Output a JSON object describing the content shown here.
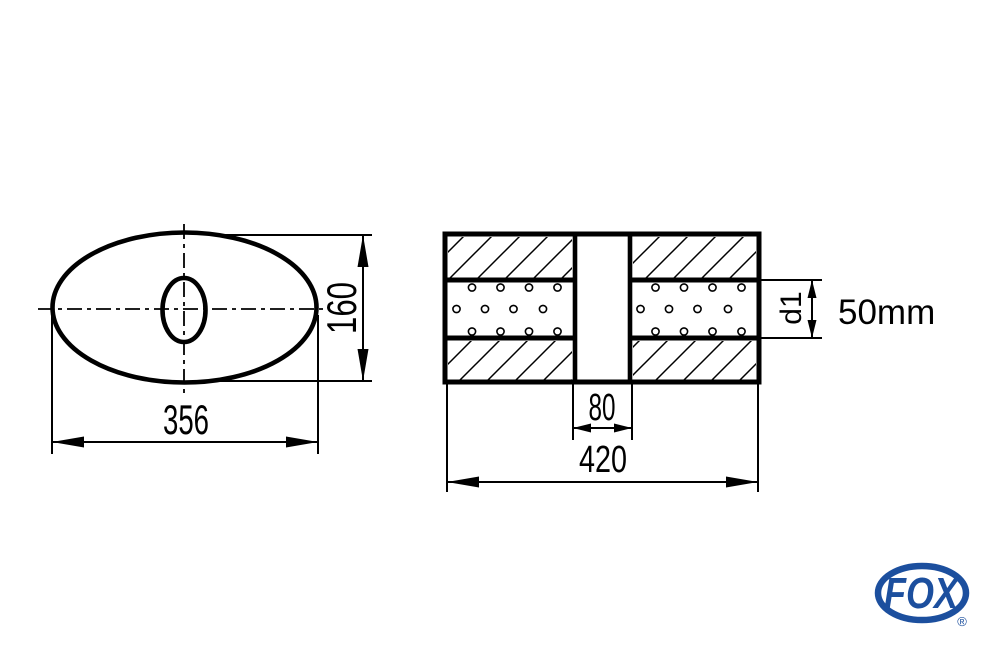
{
  "drawing": {
    "title": "universal silencer technical drawing",
    "front_view": {
      "width_dim": "356",
      "height_dim": "160"
    },
    "side_view": {
      "center_gap_dim": "80",
      "length_dim": "420",
      "pipe_dim_label": "d1",
      "pipe_diameter": "50mm"
    }
  },
  "logo": {
    "brand": "FOX",
    "registered_mark": "®",
    "color": "#1C4F9E"
  }
}
